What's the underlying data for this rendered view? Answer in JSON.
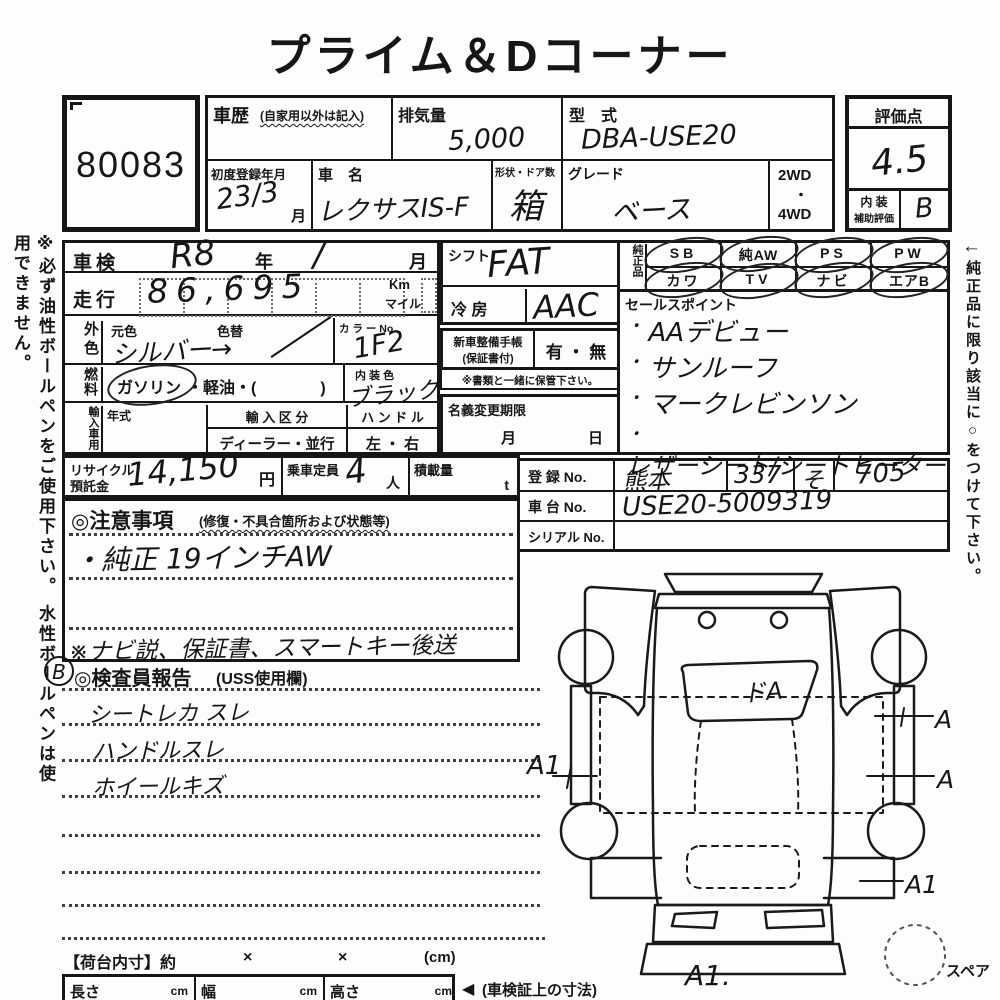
{
  "title": "プライム＆Dコーナー",
  "lot_no": "80083",
  "header": {
    "history_label": "車歴",
    "history_note": "(自家用以外は記入)",
    "displacement_label": "排気量",
    "displacement_value": "5,000",
    "model_label": "型　式",
    "model_value": "DBA-USE20",
    "first_reg_label": "初度登録年月",
    "first_reg_value": "23/3",
    "month_suffix": "月",
    "car_name_label": "車　名",
    "car_name_value": "レクサスIS-F",
    "body_label": "形状・ドア数",
    "body_value": "箱",
    "grade_label": "グレード",
    "grade_value": "ベース",
    "drive_top": "2WD",
    "drive_dot": "・",
    "drive_bottom": "4WD"
  },
  "score": {
    "label": "評価点",
    "value": "4.5",
    "interior_label_1": "内 装",
    "interior_label_2": "補助評価",
    "interior_value": "B"
  },
  "vehicle": {
    "shaken_label": "車検",
    "shaken_year": "R8",
    "year_suffix": "年",
    "shaken_month": "/",
    "month_suffix": "月",
    "mileage_label": "走行",
    "mileage_value": "86,695",
    "km_label": "Km",
    "mile_label": "マイル",
    "ext_color_label": "外色",
    "orig_color_label": "元色",
    "color_change_label": "色替",
    "color_value": "シルバー→",
    "color_no_label": "カ ラ ー No.",
    "color_no_value": "1F2",
    "fuel_label": "燃料",
    "fuel_option_1": "ガソリン",
    "fuel_option_rest": "・軽油・(　　　　)",
    "int_color_label": "内 装 色",
    "int_color_value": "ブラック",
    "import_label": "輸入車用",
    "year_model_label": "年式",
    "import_class_label": "輸 入 区 分",
    "import_class_value": "ディーラー・並行",
    "handle_label": "ハ ン ド ル",
    "handle_value": "左 ・ 右"
  },
  "recycle": {
    "label_1": "リサイクル",
    "label_2": "預託金",
    "value": "14,150",
    "unit": "円"
  },
  "capacity": {
    "label": "乗車定員",
    "value": "4",
    "unit": "人"
  },
  "load": {
    "label": "積載量",
    "unit": "t"
  },
  "notes": {
    "title": "◎注意事項",
    "subtitle": "(修復・不具合箇所および状態等)",
    "line_1": "・純正 19インチAW",
    "bottom_note": "※ナビ説、保証書、スマートキー後送"
  },
  "inspector": {
    "badge": "B",
    "title": "◎検査員報告",
    "subtitle": "(USS使用欄)",
    "lines": [
      "シートレカ スレ",
      "ハンドルスレ",
      "ホイールキズ"
    ]
  },
  "shift": {
    "label": "シフト",
    "value": "FAT"
  },
  "ac": {
    "label": "冷 房",
    "value": "AAC"
  },
  "service_book": {
    "label_1": "新車整備手帳",
    "label_2": "(保証書付)",
    "options": "有 ・ 無",
    "note": "※書類と一緒に保管下さい。"
  },
  "name_change": {
    "label": "名義変更期限",
    "month": "月",
    "day": "日"
  },
  "genuine": {
    "label": "純正品",
    "row1": [
      "SB",
      "純AW",
      "PS",
      "PW"
    ],
    "row2": [
      "カワ",
      "TV",
      "ナビ",
      "エアB"
    ]
  },
  "sales": {
    "label": "セールスポイント",
    "bullet": "・",
    "points": [
      "AAデビュー",
      "サンルーフ",
      "マークレビンソン",
      "レザーシート/シートヒーター"
    ]
  },
  "registration": {
    "reg_label": "登 録 No.",
    "area": "熊本",
    "class_no": "337",
    "kana": "そ",
    "number": "705",
    "chassis_label": "車 台 No.",
    "chassis_value": "USE20-5009319",
    "serial_label": "シリアル No."
  },
  "diagram": {
    "glass_mark": "ドA",
    "mark_left": "A1",
    "mark_right_top": "A",
    "mark_right_mid": "A",
    "mark_right_bottom": "A1",
    "mark_bottom": "A1.",
    "spare_label": "スペア"
  },
  "bed": {
    "label": "【荷台内寸】約",
    "x1": "×",
    "x2": "×",
    "unit": "(cm)"
  },
  "dims": {
    "length_label": "長さ",
    "width_label": "幅",
    "height_label": "高さ",
    "cm": "cm",
    "arrow": "◀",
    "arrow_note": "(車検証上の寸法)"
  },
  "sidebars": {
    "left": "※必ず油性ボールペンをご使用下さい。 水性ボールペンは使用できません。",
    "right_arrow": "←",
    "right": "純正品に限り該当に○をつけて下さい。"
  }
}
